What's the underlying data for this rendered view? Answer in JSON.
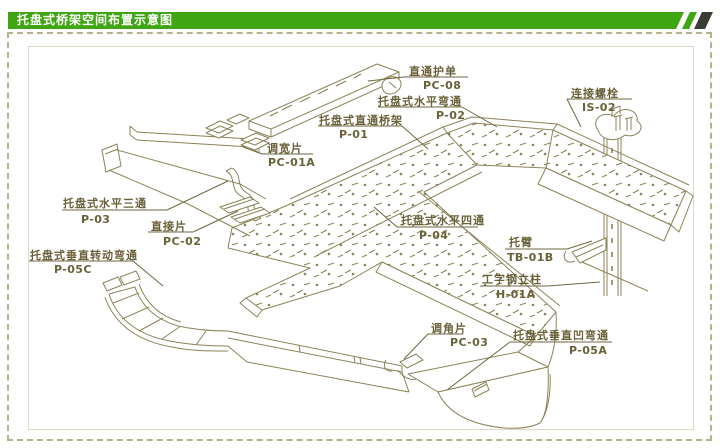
{
  "header": {
    "title": "托盘式桥架空间布置示意图",
    "banner_color": "#3fa513",
    "stripe_dark_color": "#3c3c34"
  },
  "frame": {
    "dashed_border_color": "#b7b089",
    "inner_border_color": "#ddd9c2"
  },
  "diagram": {
    "line_color": "#8d8258",
    "label_color": "#6b6139",
    "labels": [
      {
        "name": "直通护单",
        "code": "PC-08"
      },
      {
        "name": "托盘式水平弯通",
        "code": "P-02"
      },
      {
        "name": "托盘式直通桥架",
        "code": "P-01"
      },
      {
        "name": "连接螺栓",
        "code": "IS-02"
      },
      {
        "name": "调宽片",
        "code": "PC-01A"
      },
      {
        "name": "托盘式水平三通",
        "code": "P-03"
      },
      {
        "name": "直接片",
        "code": "PC-02"
      },
      {
        "name": "托盘式垂直转动弯通",
        "code": "P-05C"
      },
      {
        "name": "托盘式水平四通",
        "code": "P-04"
      },
      {
        "name": "托臂",
        "code": "TB-01B"
      },
      {
        "name": "工字钢立柱",
        "code": "H-01A"
      },
      {
        "name": "调角片",
        "code": "PC-03"
      },
      {
        "name": "托盘式垂直凹弯通",
        "code": "P-05A"
      }
    ]
  }
}
